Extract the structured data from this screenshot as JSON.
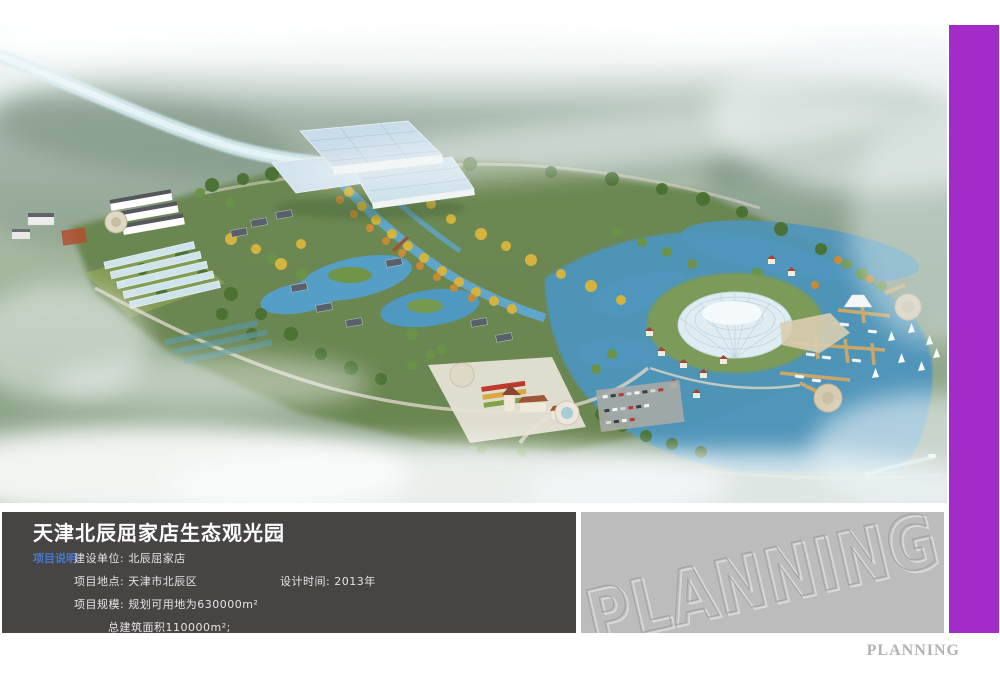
{
  "colors": {
    "accent_purple": "#a32bc7",
    "info_panel_bg": "#474444",
    "watermark_panel_bg": "#bdbcbc",
    "section_label_blue": "#4878cc",
    "footer_text_gray": "#b3b2b0"
  },
  "info_panel": {
    "title": "天津北辰屈家店生态观光园",
    "section_label": "项目说明",
    "construction_unit": "建设单位: 北辰屈家店",
    "location": "项目地点: 天津市北辰区",
    "design_time": "设计时间: 2013年",
    "scale": "项目规模: 规划可用地为630000m²",
    "total_floor_area": "总建筑面积110000m²;"
  },
  "watermark": {
    "text": "PLANNING"
  },
  "footer": {
    "brand": "PLANNING"
  }
}
